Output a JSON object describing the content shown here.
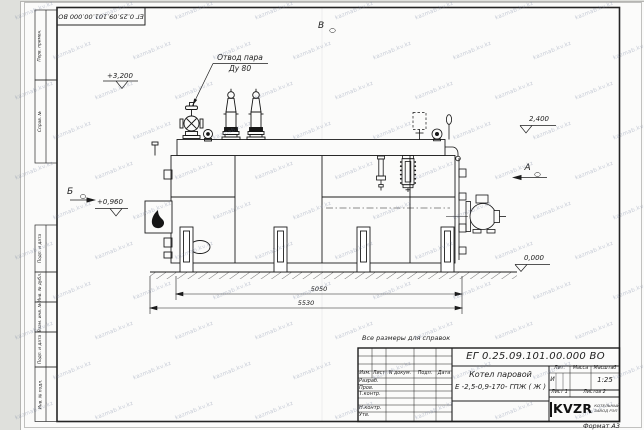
{
  "document": {
    "doc_number": "ЕГ 0.25.09.101.00.000  ВО",
    "format_label": "Формат А3",
    "reference_note": "Все размеры для справок"
  },
  "margin_columns": {
    "top": [
      "Перв. примен.",
      "Справ. №"
    ],
    "bottom": [
      "Подп. и дата",
      "Инв. № дубл.",
      "Взам. инв. №",
      "Подп. и дата",
      "Инв. № подл."
    ]
  },
  "annotations": {
    "steam_outlet_line1": "Отвод пара",
    "steam_outlet_line2": "Ду 80",
    "level_top": "+3,200",
    "level_drum": "2,400",
    "level_burner": "+0,960",
    "level_ground": "0,000",
    "view_v": "В",
    "view_a": "А",
    "view_b": "Б"
  },
  "dimensions": {
    "boiler_length": "5050",
    "overall_length": "5530"
  },
  "title_block": {
    "product_name_line1": "Котел паровой",
    "product_name_line2": "Е -2,5-0,9-170- ГПЖ ( Ж )",
    "col_headers": [
      "Изм.",
      "Лист",
      "N докум.",
      "Подп.",
      "Дата"
    ],
    "row_labels": [
      "Разраб.",
      "Пров.",
      "Т.контр.",
      "Н.контр.",
      "Утв."
    ],
    "lit_header": "Лит.",
    "mass_header": "Масса",
    "scale_header": "Масштаб",
    "lit_value": "И",
    "scale_value": "1:25",
    "sheet_info": "Лист 1",
    "sheets_info": "Листов 2",
    "logo_text": "KVZR",
    "logo_caption_line1": "КОТЕЛЬНЫЙ",
    "logo_caption_line2": "ЗАВОД РЭП"
  },
  "watermark": {
    "text": "kazmab.kv.kz"
  }
}
